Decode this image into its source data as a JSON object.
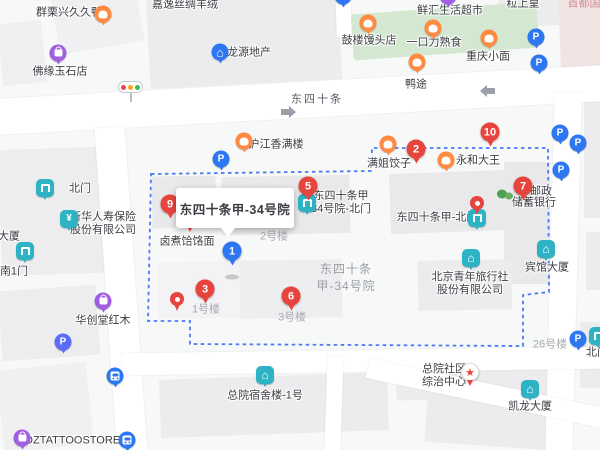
{
  "map": {
    "colors": {
      "red": "#e8443e",
      "blue": "#2e77f2",
      "teal": "#2db3c4",
      "orange": "#ff8a40",
      "purple": "#a05fe2",
      "boundary": "#4b79f7",
      "park_green": "#d4e8d1",
      "road": "#ffffff"
    },
    "tooltip": {
      "text": "东四十条甲-34号院",
      "style": "left:176px;top:188px;width:118px;height:40px"
    },
    "boundary_path": "M151,174 L371,171 L372,148 L548,148 L549,292 L523,295 L523,346 L190,344 L190,321 L148,321 Z",
    "arrows": [
      {
        "dir": "east",
        "d": "M281,109 l8,0 0,-3 7,6 -7,6 0,-3 -8,0 z"
      },
      {
        "dir": "west",
        "d": "M495,88 l-8,0 0,-3 -7,6 7,6 0,-3 8,0 z"
      }
    ],
    "traffic_light_colors": [
      "#e5484d",
      "#f5a623",
      "#3fba54"
    ],
    "park": [
      352,
      8,
      186,
      46,
      -4
    ],
    "buildings": [
      [
        55,
        -10,
        85,
        58,
        -10,
        "#f0f0f2"
      ],
      [
        0,
        22,
        44,
        62,
        -6,
        "#efeff1"
      ],
      [
        148,
        -12,
        192,
        96,
        -3,
        "#ececee"
      ],
      [
        498,
        -10,
        64,
        36,
        -2,
        "#ececee"
      ],
      [
        560,
        -6,
        42,
        98,
        -2,
        "#f2e4e2"
      ],
      [
        584,
        100,
        18,
        118,
        0,
        "#ececee"
      ],
      [
        586,
        232,
        14,
        58,
        0,
        "#ececee"
      ],
      [
        0,
        148,
        126,
        126,
        -2,
        "#ededef"
      ],
      [
        0,
        288,
        98,
        70,
        -4,
        "#ededef"
      ],
      [
        0,
        366,
        90,
        82,
        -6,
        "#f0f0f1"
      ],
      [
        152,
        176,
        64,
        52,
        -1,
        "#e9e9eb"
      ],
      [
        222,
        176,
        128,
        58,
        -1,
        "#e9e9eb"
      ],
      [
        390,
        172,
        120,
        60,
        -2,
        "#e9e9eb"
      ],
      [
        504,
        162,
        46,
        122,
        0,
        "#e9e9eb"
      ],
      [
        158,
        262,
        94,
        56,
        -1,
        "#f3f3f5"
      ],
      [
        240,
        260,
        102,
        58,
        -1,
        "#eeeef0"
      ],
      [
        418,
        260,
        94,
        50,
        -1,
        "#ececee"
      ],
      [
        160,
        376,
        228,
        58,
        -2,
        "#ececee"
      ],
      [
        396,
        350,
        152,
        48,
        -2,
        "#ececee"
      ],
      [
        426,
        396,
        128,
        50,
        4,
        "#ececee"
      ],
      [
        580,
        322,
        20,
        66,
        0,
        "#ececee"
      ]
    ],
    "roads": [
      [
        -10,
        82,
        620,
        36,
        -3.2
      ],
      [
        106,
        127,
        30,
        330,
        -4
      ],
      [
        336,
        -8,
        15,
        45,
        -2
      ],
      [
        550,
        92,
        27,
        365,
        1.5
      ],
      [
        122,
        350,
        484,
        22,
        -0.8
      ],
      [
        365,
        384,
        250,
        20,
        12
      ],
      [
        326,
        356,
        16,
        96,
        2
      ]
    ],
    "labels": [
      {
        "t": "群栗兴久久鸭",
        "x": 69,
        "y": 13,
        "cls": "d",
        "name": "poi-label-qunlixing-duck",
        "inter": true
      },
      {
        "t": "嘉逸丝绸羊绒",
        "x": 185,
        "y": 5,
        "cls": "d",
        "name": "poi-label-jiayi-silk",
        "inter": true
      },
      {
        "t": "鲜汇生活超市",
        "x": 450,
        "y": 11,
        "cls": "d",
        "name": "poi-label-xianhui-market",
        "inter": true
      },
      {
        "t": "粒上皇",
        "x": 523,
        "y": 4,
        "cls": "d",
        "name": "poi-label-lishanghuang",
        "inter": true
      },
      {
        "t": "首都国",
        "x": 584,
        "y": 4,
        "cls": "pk",
        "name": "district-label-shoudu",
        "inter": false
      },
      {
        "t": "鼓楼馒头店",
        "x": 369,
        "y": 41,
        "cls": "d",
        "name": "poi-label-gulou-baozi",
        "inter": true
      },
      {
        "t": "一口力熟食",
        "x": 434,
        "y": 43,
        "cls": "d",
        "name": "poi-label-yikouli-deli",
        "inter": true
      },
      {
        "t": "重庆小面",
        "x": 488,
        "y": 57,
        "cls": "d",
        "name": "poi-label-chongqing-noodles",
        "inter": true
      },
      {
        "t": "鸭途",
        "x": 416,
        "y": 85,
        "cls": "d",
        "name": "poi-label-yatu",
        "inter": true
      },
      {
        "t": "龙源地产",
        "x": 249,
        "y": 53,
        "cls": "d",
        "name": "poi-label-longyuan-realty",
        "inter": true
      },
      {
        "t": "佛缘玉石店",
        "x": 60,
        "y": 72,
        "cls": "d",
        "name": "poi-label-foyuan-jade",
        "inter": true
      },
      {
        "t": "东四十条",
        "x": 317,
        "y": 100,
        "cls": "st",
        "name": "street-label-dongsishitiao",
        "inter": false
      },
      {
        "t": "沪江香满楼",
        "x": 276,
        "y": 145,
        "cls": "d",
        "name": "poi-label-hujiang-restaurant",
        "inter": true
      },
      {
        "t": "满姐饺子",
        "x": 389,
        "y": 164,
        "cls": "d",
        "name": "poi-label-manjie-dumplings",
        "inter": true
      },
      {
        "t": "永和大王",
        "x": 478,
        "y": 161,
        "cls": "d",
        "name": "poi-label-yonghe-king",
        "inter": true
      },
      {
        "t": "北门",
        "x": 80,
        "y": 189,
        "cls": "d",
        "name": "gate-label-north-gate",
        "inter": true
      },
      {
        "lines": [
          "新华人寿保险",
          "股份有限公司"
        ],
        "x": 103,
        "y": 224,
        "cls": "d",
        "name": "poi-label-xinhua-insurance",
        "inter": true
      },
      {
        "t": "大厦",
        "x": 9,
        "y": 237,
        "cls": "d",
        "name": "poi-label-tower-partial",
        "inter": true
      },
      {
        "t": "南1门",
        "x": 14,
        "y": 272,
        "cls": "d",
        "name": "gate-label-south-gate-1",
        "inter": true
      },
      {
        "lines": [
          "东四十条甲",
          "34号院-北门"
        ],
        "x": 341,
        "y": 203,
        "cls": "d",
        "name": "gate-label-yard34-north-gate",
        "inter": true
      },
      {
        "t": "东四十条甲-北门",
        "x": 437,
        "y": 218,
        "cls": "d",
        "name": "gate-label-jia-north-gate",
        "inter": true
      },
      {
        "t": "邮政",
        "x": 541,
        "y": 192,
        "cls": "d",
        "name": "poi-label-postal-line1",
        "inter": true
      },
      {
        "t": "储蓄银行",
        "x": 534,
        "y": 203,
        "cls": "d",
        "name": "poi-label-postal-line2",
        "inter": true
      },
      {
        "t": "卤煮饸饹面",
        "x": 187,
        "y": 242,
        "cls": "d",
        "name": "poi-label-luzhu-noodles",
        "inter": true
      },
      {
        "t": "2号楼",
        "x": 274,
        "y": 237,
        "cls": "g",
        "name": "building-label-no2",
        "inter": false
      },
      {
        "lines": [
          "东四十条",
          "甲-34号院"
        ],
        "x": 346,
        "y": 278,
        "cls": "ga",
        "name": "area-label-yard34",
        "inter": false
      },
      {
        "t": "宾馆大厦",
        "x": 547,
        "y": 268,
        "cls": "d",
        "name": "poi-label-hotel-tower",
        "inter": true
      },
      {
        "lines": [
          "北京青年旅行社",
          "股份有限公司"
        ],
        "x": 470,
        "y": 284,
        "cls": "d",
        "name": "poi-label-youth-travel",
        "inter": true
      },
      {
        "t": "1号楼",
        "x": 206,
        "y": 310,
        "cls": "g",
        "name": "building-label-no1",
        "inter": false
      },
      {
        "t": "3号楼",
        "x": 292,
        "y": 318,
        "cls": "g",
        "name": "building-label-no3",
        "inter": false
      },
      {
        "t": "华创堂红木",
        "x": 103,
        "y": 321,
        "cls": "d",
        "name": "poi-label-huachuangtang",
        "inter": true
      },
      {
        "t": "26号楼",
        "x": 550,
        "y": 345,
        "cls": "g",
        "name": "building-label-no26",
        "inter": false
      },
      {
        "lines": [
          "总院社区",
          "综治中心"
        ],
        "x": 444,
        "y": 376,
        "cls": "d",
        "name": "poi-label-community-center",
        "inter": true
      },
      {
        "t": "北门",
        "x": 597,
        "y": 353,
        "cls": "d",
        "name": "gate-label-north-gate-right",
        "inter": true
      },
      {
        "t": "总院宿舍楼-1号",
        "x": 265,
        "y": 396,
        "cls": "d",
        "name": "poi-label-dorm-building-1",
        "inter": true
      },
      {
        "t": "凯龙大厦",
        "x": 530,
        "y": 407,
        "cls": "d",
        "name": "poi-label-kailong-tower",
        "inter": true
      },
      {
        "t": "MDZTATTOOSTORE",
        "x": 68,
        "y": 441,
        "cls": "d",
        "name": "poi-label-mdz-tattoo",
        "inter": true
      }
    ],
    "pins": [
      {
        "kind": "tree",
        "x": 505,
        "y": 195,
        "name": "tree-icon",
        "inter": false
      },
      {
        "kind": "sq",
        "glyph": "gate",
        "x": 45,
        "y": 188,
        "name": "gate-poi-pin",
        "inter": true
      },
      {
        "kind": "sq",
        "glyph": "gate",
        "x": 25,
        "y": 251,
        "name": "gate-poi-pin",
        "inter": true
      },
      {
        "kind": "sq",
        "glyph": "gate",
        "x": 307,
        "y": 203,
        "name": "gate-poi-pin",
        "inter": true
      },
      {
        "kind": "sq",
        "glyph": "gate",
        "x": 477,
        "y": 218,
        "name": "gate-poi-pin",
        "inter": true
      },
      {
        "kind": "sq",
        "glyph": "gate",
        "x": 598,
        "y": 336,
        "name": "gate-poi-pin",
        "inter": true
      },
      {
        "kind": "sq",
        "glyph": "yen",
        "x": 69,
        "y": 219,
        "name": "bank-poi-pin",
        "inter": true
      },
      {
        "kind": "sq",
        "glyph": "house",
        "x": 546,
        "y": 249,
        "name": "hotel-poi-pin",
        "inter": true
      },
      {
        "kind": "sq",
        "glyph": "house",
        "x": 471,
        "y": 258,
        "name": "company-poi-pin",
        "inter": true
      },
      {
        "kind": "sq",
        "glyph": "house",
        "x": 265,
        "y": 375,
        "name": "building-poi-pin",
        "inter": true
      },
      {
        "kind": "sq",
        "glyph": "house",
        "x": 530,
        "y": 389,
        "name": "building-poi-pin",
        "inter": true
      },
      {
        "kind": "round",
        "glyph": "food",
        "c": "#ff8a40",
        "x": 103,
        "y": 14,
        "name": "restaurant-poi-pin",
        "inter": true
      },
      {
        "kind": "round",
        "glyph": "food",
        "c": "#ff8a40",
        "x": 244,
        "y": 141,
        "name": "restaurant-poi-pin",
        "inter": true
      },
      {
        "kind": "round",
        "glyph": "food",
        "c": "#ff8a40",
        "x": 368,
        "y": 23,
        "name": "restaurant-poi-pin",
        "inter": true
      },
      {
        "kind": "round",
        "glyph": "food",
        "c": "#ff8a40",
        "x": 433,
        "y": 28,
        "name": "restaurant-poi-pin",
        "inter": true
      },
      {
        "kind": "round",
        "glyph": "food",
        "c": "#ff8a40",
        "x": 489,
        "y": 38,
        "name": "restaurant-poi-pin",
        "inter": true
      },
      {
        "kind": "round",
        "glyph": "food",
        "c": "#ff8a40",
        "x": 417,
        "y": 62,
        "name": "restaurant-poi-pin",
        "inter": true
      },
      {
        "kind": "round",
        "glyph": "food",
        "c": "#ff8a40",
        "x": 388,
        "y": 144,
        "name": "restaurant-poi-pin",
        "inter": true
      },
      {
        "kind": "round",
        "glyph": "food",
        "c": "#ff8a40",
        "x": 446,
        "y": 160,
        "name": "restaurant-poi-pin",
        "inter": true
      },
      {
        "kind": "round",
        "glyph": "house",
        "c": "#2e77f2",
        "x": 220,
        "y": 52,
        "name": "realty-poi-pin",
        "inter": true
      },
      {
        "kind": "round",
        "glyph": "dot",
        "c": "#2e77f2",
        "x": 343,
        "y": -4,
        "name": "poi-pin-clipped",
        "inter": true
      },
      {
        "kind": "round",
        "glyph": "dot",
        "c": "#a05fe2",
        "x": 448,
        "y": -4,
        "name": "poi-pin-clipped",
        "inter": true
      },
      {
        "kind": "round",
        "glyph": "P",
        "c": "#2e77f2",
        "x": 221,
        "y": 159,
        "name": "parking-pin",
        "inter": true
      },
      {
        "kind": "round",
        "glyph": "P",
        "c": "#2e77f2",
        "x": 539,
        "y": 63,
        "name": "parking-pin",
        "inter": true
      },
      {
        "kind": "round",
        "glyph": "P",
        "c": "#2e77f2",
        "x": 560,
        "y": 133,
        "name": "parking-pin",
        "inter": true
      },
      {
        "kind": "round",
        "glyph": "P",
        "c": "#2e77f2",
        "x": 578,
        "y": 143,
        "name": "parking-pin",
        "inter": true
      },
      {
        "kind": "round",
        "glyph": "P",
        "c": "#2e77f2",
        "x": 578,
        "y": 339,
        "name": "parking-pin",
        "inter": true
      },
      {
        "kind": "round",
        "glyph": "P",
        "c": "#5b6bf5",
        "x": 63,
        "y": 342,
        "name": "parking-pin",
        "inter": true
      },
      {
        "kind": "round",
        "glyph": "P",
        "c": "#2e77f2",
        "x": 536,
        "y": 37,
        "name": "parking-entrance-pin",
        "inter": true
      },
      {
        "kind": "round",
        "glyph": "P",
        "c": "#2e77f2",
        "x": 561,
        "y": 170,
        "name": "parking-entrance-pin",
        "inter": true
      },
      {
        "kind": "round",
        "glyph": "bus",
        "c": "#2e77f2",
        "x": 115,
        "y": 376,
        "name": "bus-stop-pin",
        "inter": true
      },
      {
        "kind": "round",
        "glyph": "bus",
        "c": "#2e77f2",
        "x": 127,
        "y": 440,
        "name": "bus-stop-pin",
        "inter": true
      },
      {
        "kind": "round",
        "glyph": "bag",
        "c": "#a05fe2",
        "x": 58,
        "y": 53,
        "name": "shop-poi-pin",
        "inter": true
      },
      {
        "kind": "round",
        "glyph": "bag",
        "c": "#a05fe2",
        "x": 103,
        "y": 301,
        "name": "shop-poi-pin",
        "inter": true
      },
      {
        "kind": "round",
        "glyph": "bag",
        "c": "#a05fe2",
        "x": 22,
        "y": 438,
        "name": "shop-poi-pin",
        "inter": true
      },
      {
        "kind": "star",
        "x": 470,
        "y": 372,
        "name": "community-center-pin",
        "inter": true
      },
      {
        "kind": "shadow",
        "x": 232,
        "y": 277,
        "name": "marker-shadow",
        "inter": false
      },
      {
        "kind": "dot",
        "x": 177,
        "y": 299,
        "name": "location-pin",
        "inter": true
      },
      {
        "kind": "dot",
        "x": 477,
        "y": 203,
        "name": "location-pin",
        "inter": true
      },
      {
        "kind": "tip",
        "x": 190,
        "y": 230,
        "name": "hidden-pin-tip",
        "inter": false
      },
      {
        "kind": "num",
        "n": "1",
        "c": "#2e77f2",
        "x": 232,
        "y": 251,
        "name": "result-marker-1",
        "inter": true
      },
      {
        "kind": "num",
        "n": "2",
        "x": 416,
        "y": 149,
        "name": "result-marker-2",
        "inter": true
      },
      {
        "kind": "num",
        "n": "3",
        "x": 205,
        "y": 289,
        "name": "result-marker-3",
        "inter": true
      },
      {
        "kind": "num",
        "n": "5",
        "x": 308,
        "y": 186,
        "name": "result-marker-5",
        "inter": true
      },
      {
        "kind": "num",
        "n": "6",
        "x": 291,
        "y": 296,
        "name": "result-marker-6",
        "inter": true
      },
      {
        "kind": "num",
        "n": "7",
        "x": 523,
        "y": 186,
        "name": "result-marker-7",
        "inter": true
      },
      {
        "kind": "num",
        "n": "9",
        "x": 170,
        "y": 204,
        "name": "result-marker-9",
        "inter": true
      },
      {
        "kind": "num",
        "n": "10",
        "x": 490,
        "y": 132,
        "name": "result-marker-10",
        "inter": true
      }
    ]
  }
}
